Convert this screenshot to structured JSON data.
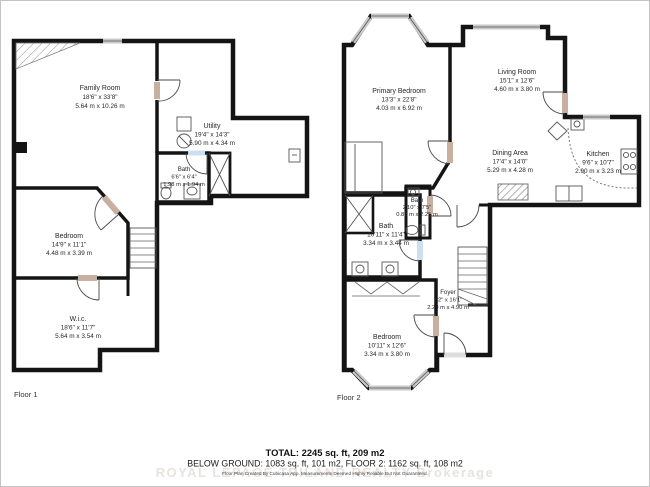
{
  "floors": [
    {
      "label": "Floor 1",
      "rooms": [
        {
          "id": "family-room",
          "name": "Family Room",
          "imperial": "18'6\" x 33'8\"",
          "metric": "5.64 m x 10.26 m"
        },
        {
          "id": "utility",
          "name": "Utility",
          "imperial": "19'4\" x 14'3\"",
          "metric": "5.90 m x 4.34 m"
        },
        {
          "id": "bath",
          "name": "Bath",
          "imperial": "6'6\" x 6'4\"",
          "metric": "1.98 m x 1.94 m"
        },
        {
          "id": "bedroom",
          "name": "Bedroom",
          "imperial": "14'9\" x 11'1\"",
          "metric": "4.48 m x 3.39 m"
        },
        {
          "id": "wic",
          "name": "W.i.c.",
          "imperial": "18'6\" x 11'7\"",
          "metric": "5.64 m x 3.54 m"
        }
      ]
    },
    {
      "label": "Floor 2",
      "rooms": [
        {
          "id": "primary-bedroom",
          "name": "Primary Bedroom",
          "imperial": "13'3\" x 22'8\"",
          "metric": "4.03 m x 6.92 m"
        },
        {
          "id": "living-room",
          "name": "Living Room",
          "imperial": "15'1\" x 12'6\"",
          "metric": "4.60 m x 3.80 m"
        },
        {
          "id": "dining-area",
          "name": "Dining Area",
          "imperial": "17'4\" x 14'0\"",
          "metric": "5.29 m x 4.28 m"
        },
        {
          "id": "kitchen",
          "name": "Kitchen",
          "imperial": "9'6\" x 10'7\"",
          "metric": "2.90 m x 3.23 m"
        },
        {
          "id": "bath-small",
          "name": "Bath",
          "imperial": "2'10\" x 7'5\"",
          "metric": "0.86 m x 2.25 m"
        },
        {
          "id": "bath-large",
          "name": "Bath",
          "imperial": "10'11\" x 11'4\"",
          "metric": "3.34 m x 3.44 m"
        },
        {
          "id": "foyer",
          "name": "Foyer",
          "imperial": "7'2\" x 16'1\"",
          "metric": "2.20 m x 4.90 m"
        },
        {
          "id": "bedroom",
          "name": "Bedroom",
          "imperial": "10'11\" x 12'6\"",
          "metric": "3.34 m x 3.80 m"
        }
      ]
    }
  ],
  "footer": {
    "total": "TOTAL: 2245 sq. ft, 209 m2",
    "breakdown": "BELOW GROUND: 1083 sq. ft, 101 m2, FLOOR 2: 1162 sq. ft, 108 m2",
    "disclaimer": "Floor Plan Created By Cubicasa App. Measurements Deemed Highly Reliable But Not Guaranteed.",
    "watermark": "ROYAL LEPAGE TRILAND REALTY Brokerage"
  },
  "colors": {
    "room_fill": "#c8b0a1",
    "accent_room_fill": "#fcd8a4",
    "bath_fill": "#cde0f0",
    "wall": "#141414",
    "window": "#c9c9c9"
  }
}
